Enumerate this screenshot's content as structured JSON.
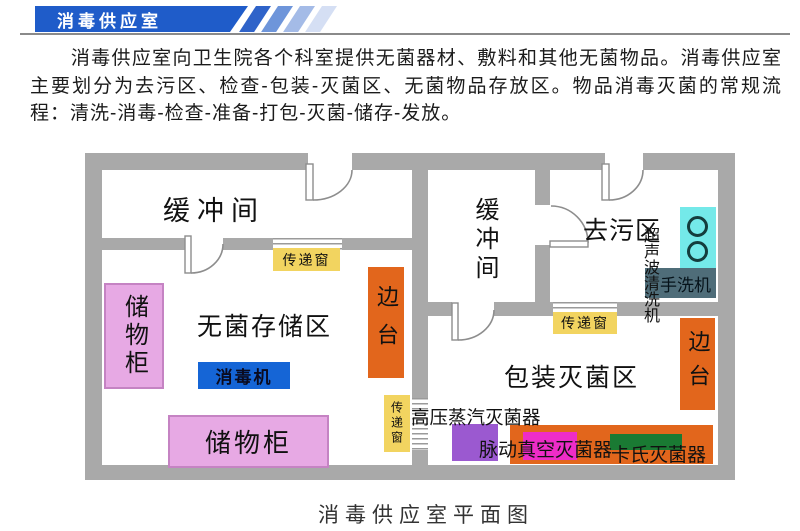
{
  "header": {
    "banner_title": "消毒供应室",
    "banner_color": "#1f5cc9",
    "stripe_colors": [
      "#2f63c9",
      "#6e95da",
      "#a4bbe7",
      "#d5dff4"
    ],
    "rule_color": "#8a8a8a"
  },
  "intro": {
    "text": "消毒供应室向卫生院各个科室提供无菌器材、敷料和其他无菌物品。消毒供应室主要划分为去污区、检查-包装-灭菌区、无菌物品存放区。物品消毒灭菌的常规流程：清洗-消毒-检查-准备-打包-灭菌-储存-发放。"
  },
  "floor_plan": {
    "caption": "消毒供应室平面图",
    "wall_color": "#a9a9a9",
    "rooms": {
      "buffer_room_1": {
        "label": "缓冲间"
      },
      "buffer_room_2": {
        "label": "缓冲间"
      },
      "decontamination_area": {
        "label": "去污区"
      },
      "sterile_storage_area": {
        "label": "无菌存储区"
      },
      "packing_sterilization_area": {
        "label": "包装灭菌区"
      }
    },
    "equipment": {
      "storage_cabinet_1": {
        "label": "储物柜",
        "color": "#e7a9e4"
      },
      "storage_cabinet_2": {
        "label": "储物柜",
        "color": "#e7a9e4"
      },
      "disinfector": {
        "label": "消毒机",
        "color": "#1565d6"
      },
      "side_table_1": {
        "label": "边台",
        "color": "#e2661c"
      },
      "side_table_2": {
        "label": "边台",
        "color": "#e2661c"
      },
      "transfer_window_1": {
        "label": "传递窗",
        "color": "#f2d460"
      },
      "transfer_window_2": {
        "label": "传递窗",
        "color": "#f2d460"
      },
      "transfer_window_3": {
        "label": "传递窗",
        "color": "#f2d460"
      },
      "ultrasonic_cleaner": {
        "label": "超声波清洗机"
      },
      "hand_washer": {
        "label": "手洗机",
        "color": "#4f6d79"
      },
      "sink": {
        "color": "#74e9e9"
      },
      "autoclave": {
        "label": "高压蒸汽灭菌器"
      },
      "autoclave_unit_color": "#9b59d0",
      "pulse_vacuum_sterilizer": {
        "label": "脉动真空灭菌器",
        "color": "#ee2cc8"
      },
      "cassette_sterilizer": {
        "label": "卡氏灭菌器",
        "color": "#1a7a33"
      },
      "work_counter": {
        "color": "#e2661c"
      }
    }
  }
}
